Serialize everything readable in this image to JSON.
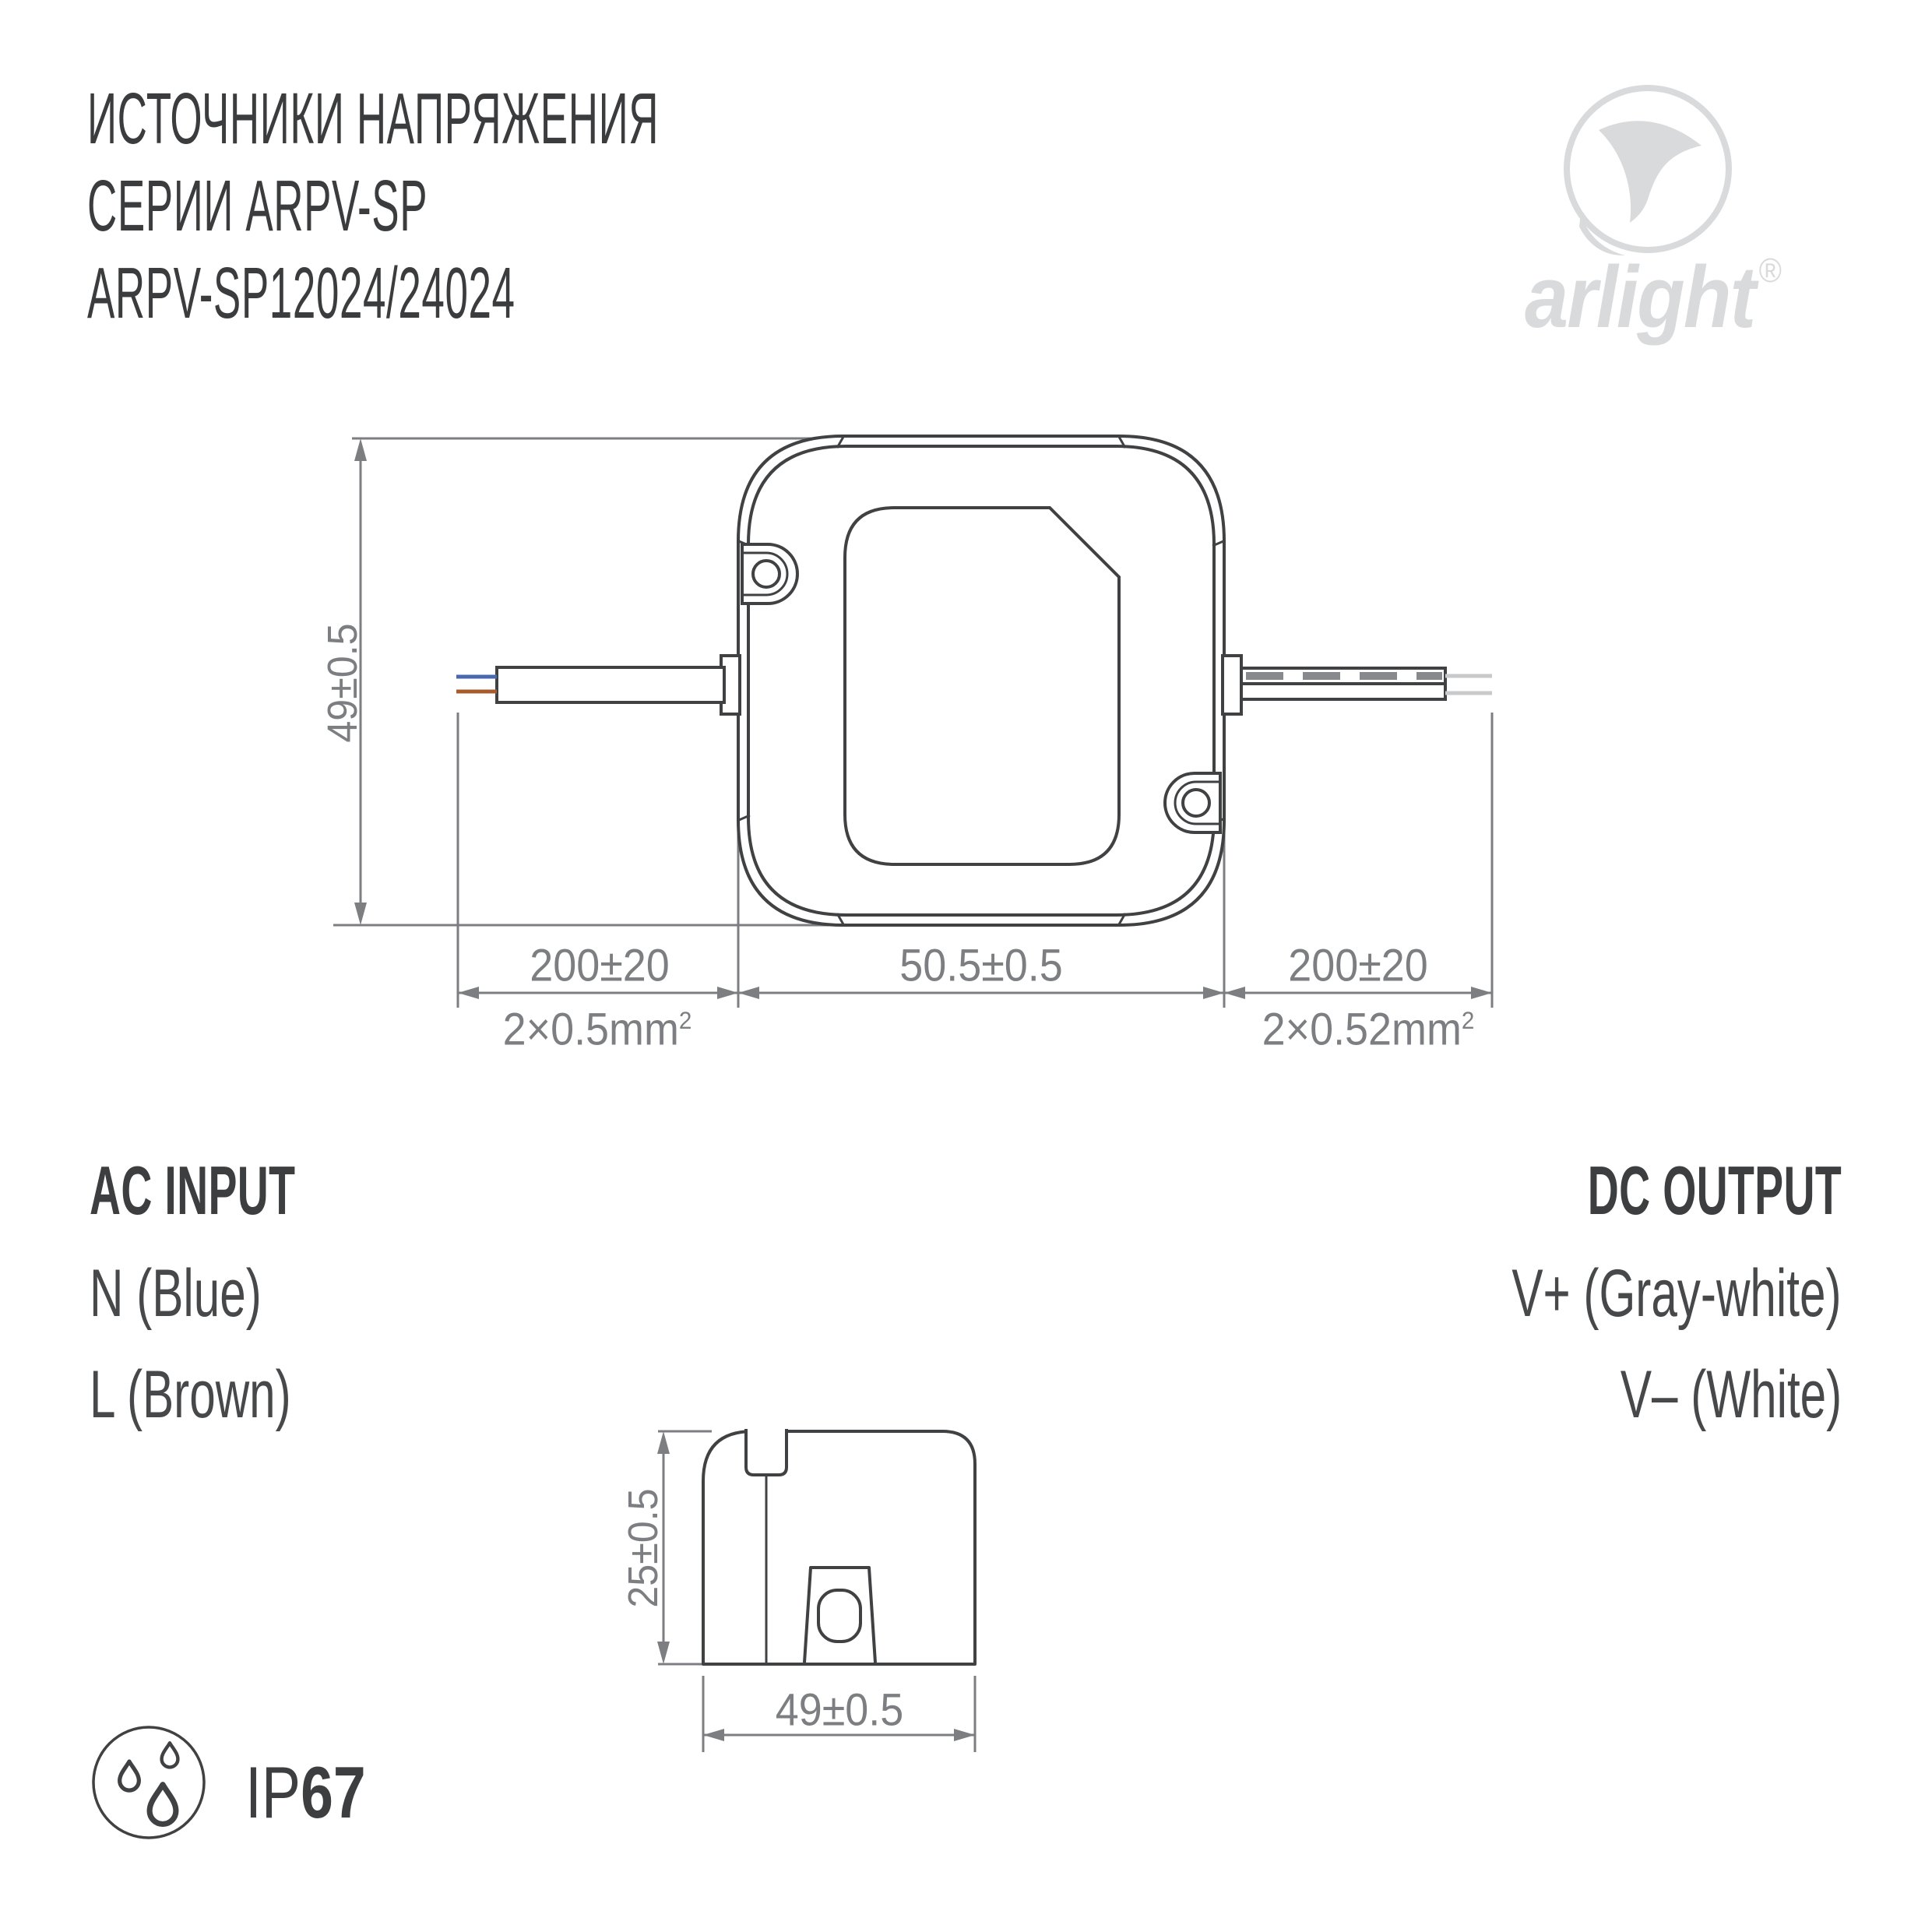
{
  "header": {
    "title_lines": [
      "ИСТОЧНИКИ НАПРЯЖЕНИЯ",
      "СЕРИИ ARPV-SP",
      "ARPV-SP12024/24024"
    ]
  },
  "logo": {
    "brand": "arlight",
    "registered_mark": "®"
  },
  "top_view": {
    "height_dim": "49±0.5",
    "input_wire_length_dim": "200±20",
    "body_width_dim": "50.5±0.5",
    "output_wire_length_dim": "200±20",
    "input_wire_spec": "2×0.5mm",
    "input_wire_spec_sup": "2",
    "output_wire_spec": "2×0.52mm",
    "output_wire_spec_sup": "2"
  },
  "connections": {
    "ac_input": {
      "title": "AC INPUT",
      "lines": [
        "N (Blue)",
        "L (Brown)"
      ]
    },
    "dc_output": {
      "title": "DC OUTPUT",
      "lines": [
        "V+ (Gray-white)",
        "V– (White)"
      ]
    }
  },
  "side_view": {
    "height_dim": "25±0.5",
    "width_dim": "49±0.5"
  },
  "protection": {
    "prefix": "IP",
    "rating": "67"
  },
  "colors": {
    "ink": "#3d3e40",
    "drawing_line": "#404143",
    "dimension_gray": "#7c7e81",
    "logo_gray": "#d9dadb",
    "wire_blue": "#4a68b0",
    "wire_brown": "#a85c2d",
    "wire_tip_gray": "#c8c9cb",
    "wire_dash_gray": "#87898c"
  }
}
